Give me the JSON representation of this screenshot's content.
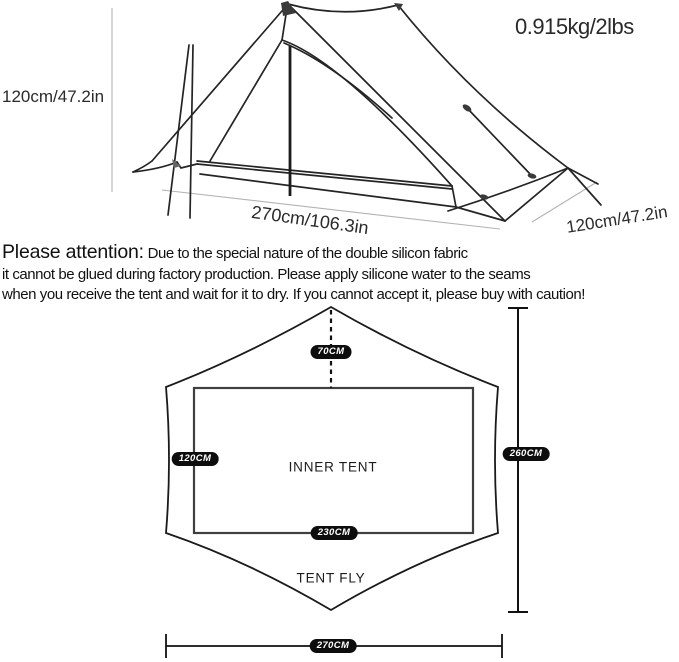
{
  "tent_view": {
    "weight": "0.915kg/2lbs",
    "height": "120cm/47.2in",
    "length": "270cm/106.3in",
    "width": "120cm/47.2in"
  },
  "attention": {
    "heading": "Please attention:",
    "line1_rest": " Due to the special nature of the double silicon fabric",
    "line2": "it cannot be glued during factory production. Please apply silicone water to the seams",
    "line3": "when you receive the tent and wait for it to dry. If you cannot accept it, please buy with caution!"
  },
  "floor_plan": {
    "peak_offset": "70CM",
    "inner_width": "120CM",
    "fly_length": "260CM",
    "inner_length": "230CM",
    "fly_width": "270CM",
    "inner_label": "INNER TENT",
    "fly_label": "TENT FLY"
  },
  "colors": {
    "line": "#222222",
    "dim_line": "#b3b3b3",
    "pill_bg": "#0d0d0d",
    "pill_text": "#ffffff"
  }
}
